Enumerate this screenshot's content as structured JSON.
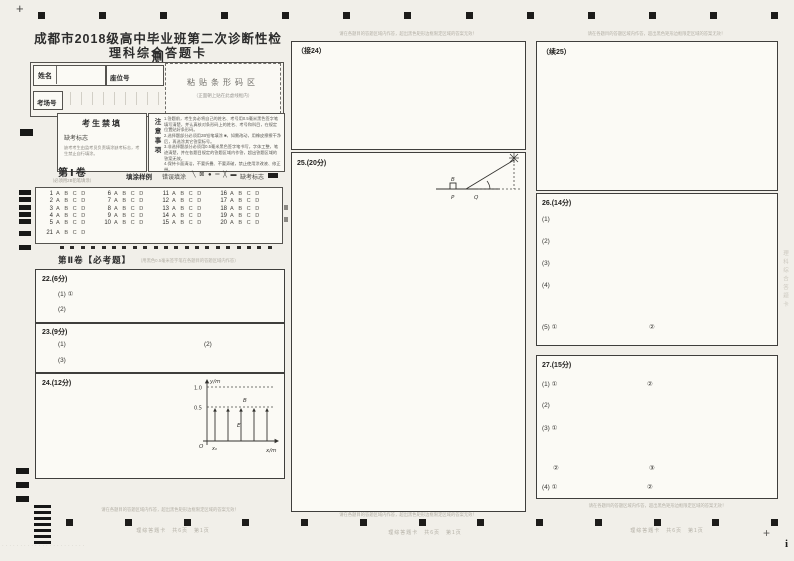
{
  "page": {
    "title_line1": "成都市2018级高中毕业班第二次诊断性检测",
    "title_line2": "理科综合答题卡",
    "crosshair": "+",
    "corner_i": "i"
  },
  "student_info": {
    "name_label": "姓名",
    "seat_label": "座位号",
    "room_label": "考场号",
    "barcode_title": "粘贴条形码区",
    "barcode_note": "（正面朝上贴在此虚线框内）"
  },
  "forbidden_box": {
    "title": "考生禁填",
    "absent_label": "缺考标志",
    "note": "缺考考生由监考员负责填涂缺考标志，考生禁止自行填涂。"
  },
  "notice": {
    "vertical_title": "注意事项",
    "items": [
      "1.答题前，考生务必将自己的姓名、考号用0.5毫米黑色签字笔填写清楚，并认真核对条形码上的姓名、考号和科目，在规定位置贴好条形码。",
      "2.选择题部分必须用2B铅笔填涂 ■，如需改动，用橡皮擦擦干净后，再选涂其它答案标号。",
      "3.非选择题部分必须用0.5毫米黑色签字笔书写，字体工整，笔迹清楚，并在各题目规定的答题区域内作答，超出答题区域的答案无效。",
      "4.保持卡面清洁，不要折叠、不要弄破，禁止使用涂改液、修正带。"
    ]
  },
  "part1": {
    "title": "第Ⅰ卷",
    "subtitle": "（必须用2B铅笔填涂）",
    "sample_label": "填涂样例",
    "wrong_label": "错误填涂",
    "wrong_symbols": "╲ ⊠ ● ═ ╳ ▬",
    "absent_label": "缺考标志",
    "numbers": [
      1,
      2,
      3,
      4,
      5,
      6,
      7,
      8,
      9,
      10,
      11,
      12,
      13,
      14,
      15,
      16,
      17,
      18,
      19,
      20,
      21
    ],
    "options": [
      "A",
      "B",
      "C",
      "D"
    ]
  },
  "part2": {
    "title": "第Ⅱ卷【必考题】",
    "subtitle": "（用黑色0.5毫米签字笔在各题目的答题区域内作答）"
  },
  "questions": {
    "q22_label": "22.(6分)",
    "q22_p1": "(1) ①",
    "q22_p2": "(2)",
    "q23_label": "23.(9分)",
    "q23_p1": "(1)",
    "q23_p2": "(2)",
    "q23_p3": "(3)",
    "q24_label": "24.(12分)",
    "q24_cont": "（接24）",
    "q25_label": "25.(20分)",
    "q25_cont": "（续25）",
    "q26_label": "26.(14分)",
    "q26_p1": "(1)",
    "q26_p2": "(2)",
    "q26_p3": "(3)",
    "q26_p4": "(4)",
    "q26_p5": "(5) ①",
    "q26_p5b": "②",
    "q27_label": "27.(15分)",
    "q27_p1": "(1) ①",
    "q27_p1b": "②",
    "q27_p2": "(2)",
    "q27_p3": "(3) ①",
    "q27_p3b": "②",
    "q27_p3c": "③",
    "q27_p4": "(4) ①",
    "q27_p4b": "②"
  },
  "figure24": {
    "ylabel": "y/m",
    "xlabel": "x/m",
    "origin": "O",
    "v1": "1.0",
    "v2": "0.5",
    "e_label": "E",
    "b_label": "B",
    "x0_label": "x₀"
  },
  "figure25": {
    "b_label": "B",
    "p_label": "P",
    "q_label": "Q"
  },
  "margins": {
    "region_note": "请在各题目的答题区域内作答，超出黑色矩形边框限定区域的答案无效！",
    "footer": "理综答题卡　共6页　第1页",
    "edge_text": "理科综合答题卡",
    "noise_dots": "·······················"
  },
  "timing": {
    "top": 13,
    "bottom": 13,
    "grid_ticks": 21,
    "room_ticks": 10,
    "barcode_bars": 7,
    "grid_left_rows": 5
  }
}
